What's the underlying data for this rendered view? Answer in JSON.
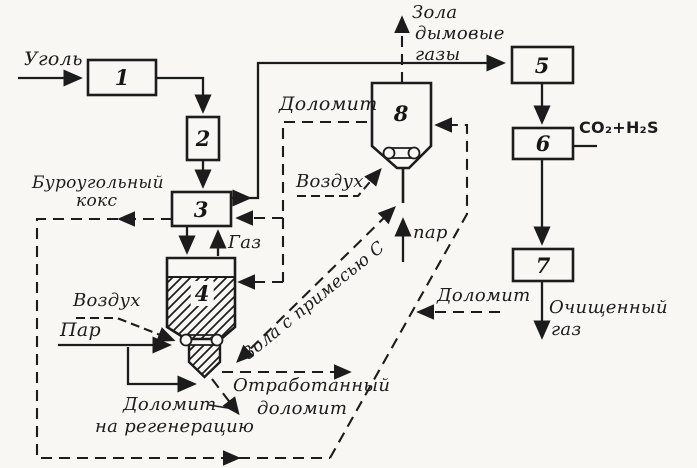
{
  "figure": {
    "kind": "process-flow-diagram",
    "language": "ru"
  },
  "colors": {
    "ink": "#1c1c1c",
    "paper": "#f8f7f3"
  },
  "unit_numbers": [
    "1",
    "2",
    "3",
    "4",
    "5",
    "6",
    "7",
    "8"
  ],
  "labels": {
    "coal": "Уголь",
    "brown_coal_coke": [
      "Буроугольный",
      "кокс"
    ],
    "dolomite_top": "Доломит",
    "air_unit8": "Воздух",
    "steam_unit8": "пар",
    "ash_flue_gases": [
      "Зола",
      "дымовые",
      "газы"
    ],
    "co2_h2s": "CO₂+H₂S",
    "gas": "Газ",
    "air_unit4": "Воздух",
    "steam_unit4": "Пар",
    "dolomite_regen": [
      "Доломит",
      "на регенерацию"
    ],
    "spent_dolomite": [
      "Отработанный",
      "доломит"
    ],
    "ash_with_c": "Зола с примесью С",
    "dolomite_right": "Доломит",
    "purified_gas": [
      "Очищенный",
      "газ"
    ]
  }
}
